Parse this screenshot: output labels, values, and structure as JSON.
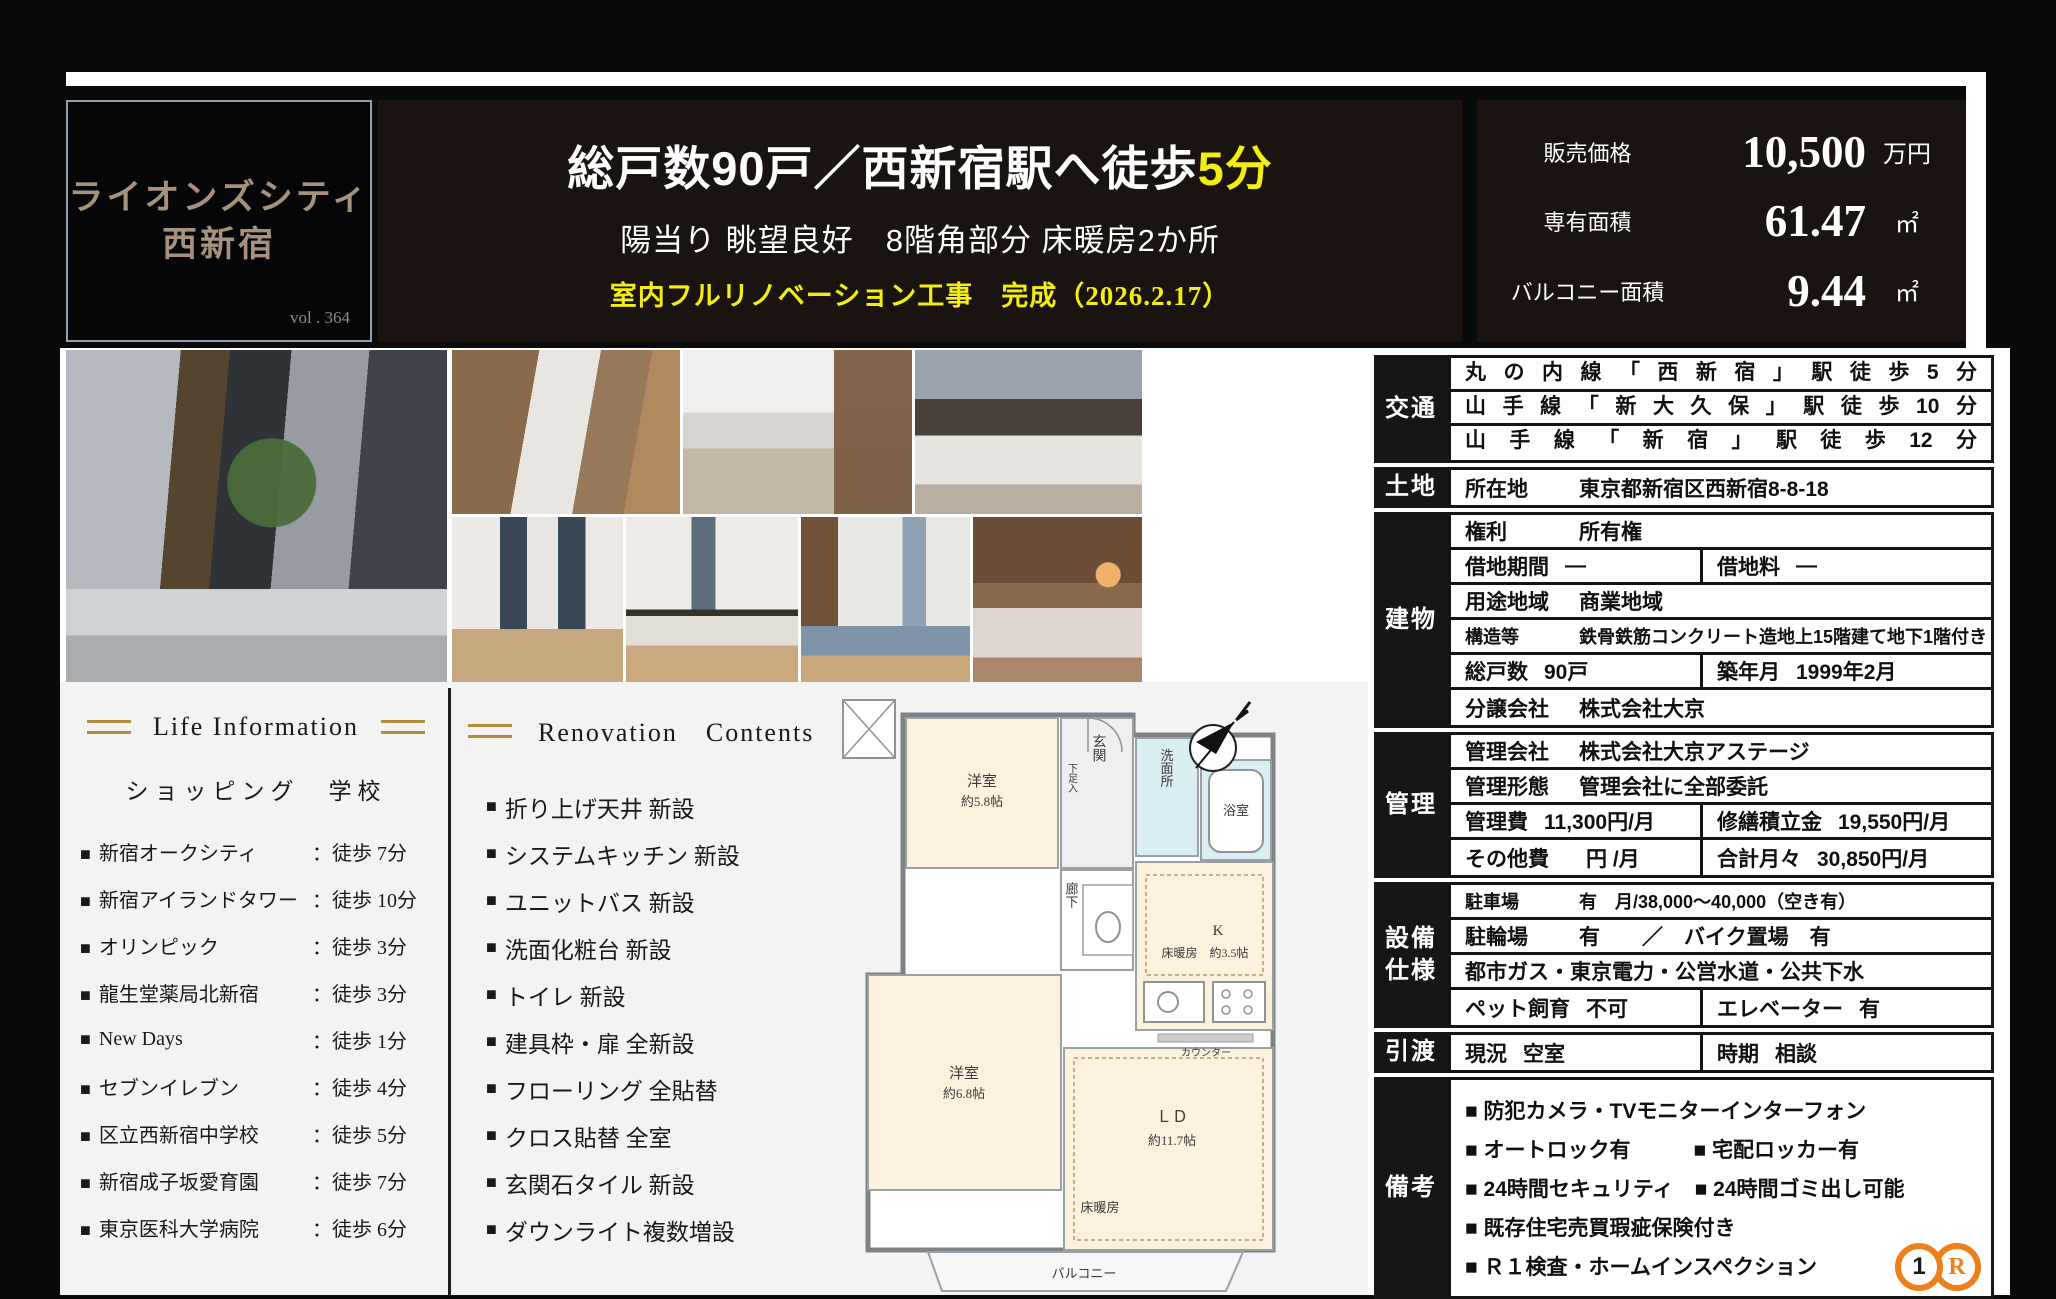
{
  "misc": {
    "bullet": "■"
  },
  "logo": {
    "line1": "ライオンズシティ",
    "line2": "西新宿",
    "vol": "vol . 364"
  },
  "headline": {
    "line1_white": "総戸数90戸／西新宿駅へ徒歩",
    "line1_yellow": "5分",
    "line2": "陽当り 眺望良好　8階角部分 床暖房2か所",
    "line3": "室内フルリノベーション工事　完成（2026.2.17）",
    "accent_yellow": "#f2ee10"
  },
  "price": {
    "rows": [
      {
        "label": "販売価格",
        "value": "10,500",
        "unit": "万円"
      },
      {
        "label": "専有面積",
        "value": "61.47",
        "unit": "㎡"
      },
      {
        "label": "バルコニー面積",
        "value": "9.44",
        "unit": "㎡"
      }
    ]
  },
  "life": {
    "title": "Life Information",
    "subtitle": "ショッピング　学校",
    "items": [
      {
        "name": "新宿オークシティ",
        "walk": "：徒歩 7分"
      },
      {
        "name": "新宿アイランドタワー",
        "walk": "：徒歩 10分"
      },
      {
        "name": "オリンピック",
        "walk": "：徒歩 3分"
      },
      {
        "name": "龍生堂薬局北新宿",
        "walk": "：徒歩 3分"
      },
      {
        "name": "New Days",
        "walk": "：徒歩 1分"
      },
      {
        "name": "セブンイレブン",
        "walk": "：徒歩 4分"
      },
      {
        "name": "区立西新宿中学校",
        "walk": "：徒歩 5分"
      },
      {
        "name": "新宿成子坂愛育園",
        "walk": "：徒歩 7分"
      },
      {
        "name": "東京医科大学病院",
        "walk": "：徒歩 6分"
      }
    ]
  },
  "renovation": {
    "title": "Renovation　Contents",
    "items": [
      "折り上げ天井 新設",
      "システムキッチン 新設",
      "ユニットバス 新設",
      "洗面化粧台 新設",
      "トイレ 新設",
      "建具枠・扉 全新設",
      "フローリング 全貼替",
      "クロス貼替 全室",
      "玄関石タイル 新設",
      "ダウンライト複数増設"
    ]
  },
  "floorplan": {
    "room1_l1": "洋室",
    "room1_l2": "約5.8帖",
    "genkan": "玄関",
    "getabako": "下足入",
    "senmenjo": "洗面所",
    "yokushitsu": "浴室",
    "rouka": "廊下",
    "k": "K",
    "k_detail": "床暖房　約3.5帖",
    "counter": "カウンター",
    "room2_l1": "洋室",
    "room2_l2": "約6.8帖",
    "ld": "ＬＤ",
    "ld_size": "約11.7帖",
    "yukadanbou": "床暖房",
    "balcony": "バルコニー"
  },
  "spec_table": {
    "groups": [
      {
        "label": "交通",
        "rows": [
          {
            "type": "lines",
            "lines": [
              "丸の内線「西新宿」駅徒歩5分",
              "山手線「新大久保」駅徒歩10分",
              "山手線「新宿」駅徒歩12分"
            ]
          }
        ]
      },
      {
        "label": "土地",
        "rows": [
          {
            "type": "single",
            "head": "所在地",
            "value": "東京都新宿区西新宿8-8-18"
          }
        ]
      },
      {
        "label": "建物",
        "rows": [
          {
            "type": "single",
            "head": "権利",
            "value": "所有権"
          },
          {
            "type": "split",
            "cells": [
              {
                "head": "借地期間",
                "value": "―"
              },
              {
                "head": "借地料",
                "value": "―"
              }
            ]
          },
          {
            "type": "single",
            "head": "用途地域",
            "value": "商業地域"
          },
          {
            "type": "single",
            "head": "構造等",
            "value": "鉄骨鉄筋コンクリート造地上15階建て地下1階付き　8階"
          },
          {
            "type": "split",
            "cells": [
              {
                "head": "総戸数",
                "value": "90戸"
              },
              {
                "head": "築年月",
                "value": "1999年2月"
              }
            ]
          },
          {
            "type": "single",
            "head": "分譲会社",
            "value": "株式会社大京"
          }
        ]
      },
      {
        "label": "管理",
        "rows": [
          {
            "type": "single",
            "head": "管理会社",
            "value": "株式会社大京アステージ"
          },
          {
            "type": "single",
            "head": "管理形態",
            "value": "管理会社に全部委託"
          },
          {
            "type": "split",
            "cells": [
              {
                "head": "管理費",
                "value": "11,300円/月"
              },
              {
                "head": "修繕積立金",
                "value": "19,550円/月"
              }
            ]
          },
          {
            "type": "split",
            "cells": [
              {
                "head": "その他費",
                "value": "　円 /月"
              },
              {
                "head": "合計月々",
                "value": "30,850円/月"
              }
            ]
          }
        ]
      },
      {
        "label": "設備仕様",
        "rows": [
          {
            "type": "single",
            "head": "駐車場",
            "value": "有　月/38,000～40,000（空き有）"
          },
          {
            "type": "single",
            "head": "駐輪場",
            "value": "有　　／　バイク置場　有"
          },
          {
            "type": "single",
            "head": "",
            "value": "都市ガス・東京電力・公営水道・公共下水"
          },
          {
            "type": "split",
            "cells": [
              {
                "head": "ペット飼育",
                "value": "不可"
              },
              {
                "head": "エレベーター",
                "value": "有"
              }
            ]
          }
        ]
      },
      {
        "label": "引渡",
        "rows": [
          {
            "type": "split",
            "cells": [
              {
                "head": "現況",
                "value": "空室"
              },
              {
                "head": "時期",
                "value": "相談"
              }
            ]
          }
        ]
      },
      {
        "label": "備考",
        "rows": [
          {
            "type": "bullets",
            "lines": [
              "■ 防犯カメラ・TVモニターインターフォン",
              "■ オートロック有　　　■ 宅配ロッカー有",
              "■ 24時間セキュリティ　■ 24時間ゴミ出し可能",
              "■ 既存住宅売買瑕疵保険付き",
              "■ Ｒ１検査・ホームインスペクション"
            ]
          }
        ]
      }
    ]
  },
  "footer_logo": {
    "left": "1",
    "right": "R"
  }
}
